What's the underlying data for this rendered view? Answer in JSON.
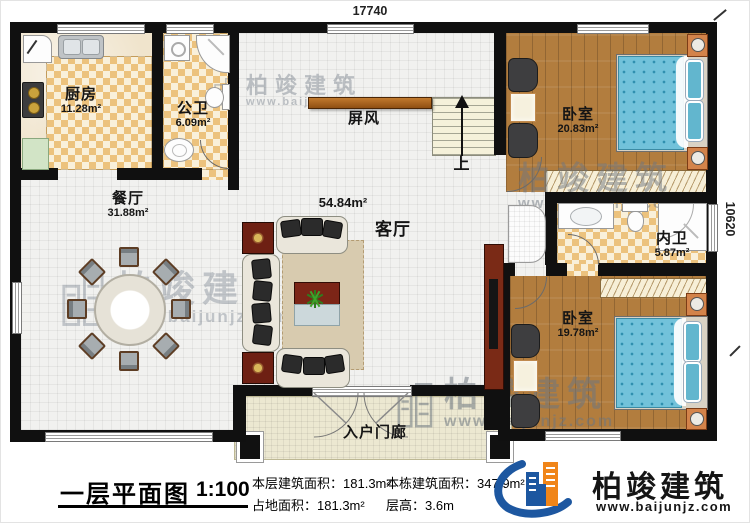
{
  "dimensions": {
    "top": "17740",
    "right": "10620"
  },
  "rooms": {
    "kitchen": {
      "name": "厨房",
      "area": "11.28m²"
    },
    "public_bath": {
      "name": "公卫",
      "area": "6.09m²"
    },
    "dining": {
      "name": "餐厅",
      "area": "31.88m²"
    },
    "living": {
      "name": "客厅",
      "area": "54.84m²"
    },
    "screen": {
      "name": "屏风"
    },
    "stairs": {
      "up_label": "上"
    },
    "bedroom_top": {
      "name": "卧室",
      "area": "20.83m²"
    },
    "ensuite_bath": {
      "name": "内卫",
      "area": "5.87m²"
    },
    "bedroom_bottom": {
      "name": "卧室",
      "area": "19.78m²"
    },
    "porch": {
      "name": "入户门廊"
    }
  },
  "title_block": {
    "title": "一层平面图",
    "scale": "1:100",
    "stats": [
      {
        "label": "本层建筑面积：",
        "value": "181.3m²"
      },
      {
        "label": "占地面积：",
        "value": "181.3m²"
      },
      {
        "label": "本栋建筑面积：",
        "value": "347.9m²"
      },
      {
        "label": "层高：",
        "value": "3.6m"
      }
    ]
  },
  "logo": {
    "name": "柏竣建筑",
    "website": "www.baijunjz.com"
  },
  "watermark": {
    "name": "柏竣建筑",
    "website": "www.baijunjz.com"
  },
  "colors": {
    "wall": "#101010",
    "wood": "#b27d3e",
    "checker_tan": "#ecc27d",
    "bed_blue": "#72c2da",
    "nightstand_orange": "#d3834a",
    "logo_blue": "#1d57a0",
    "logo_orange": "#f08519"
  }
}
